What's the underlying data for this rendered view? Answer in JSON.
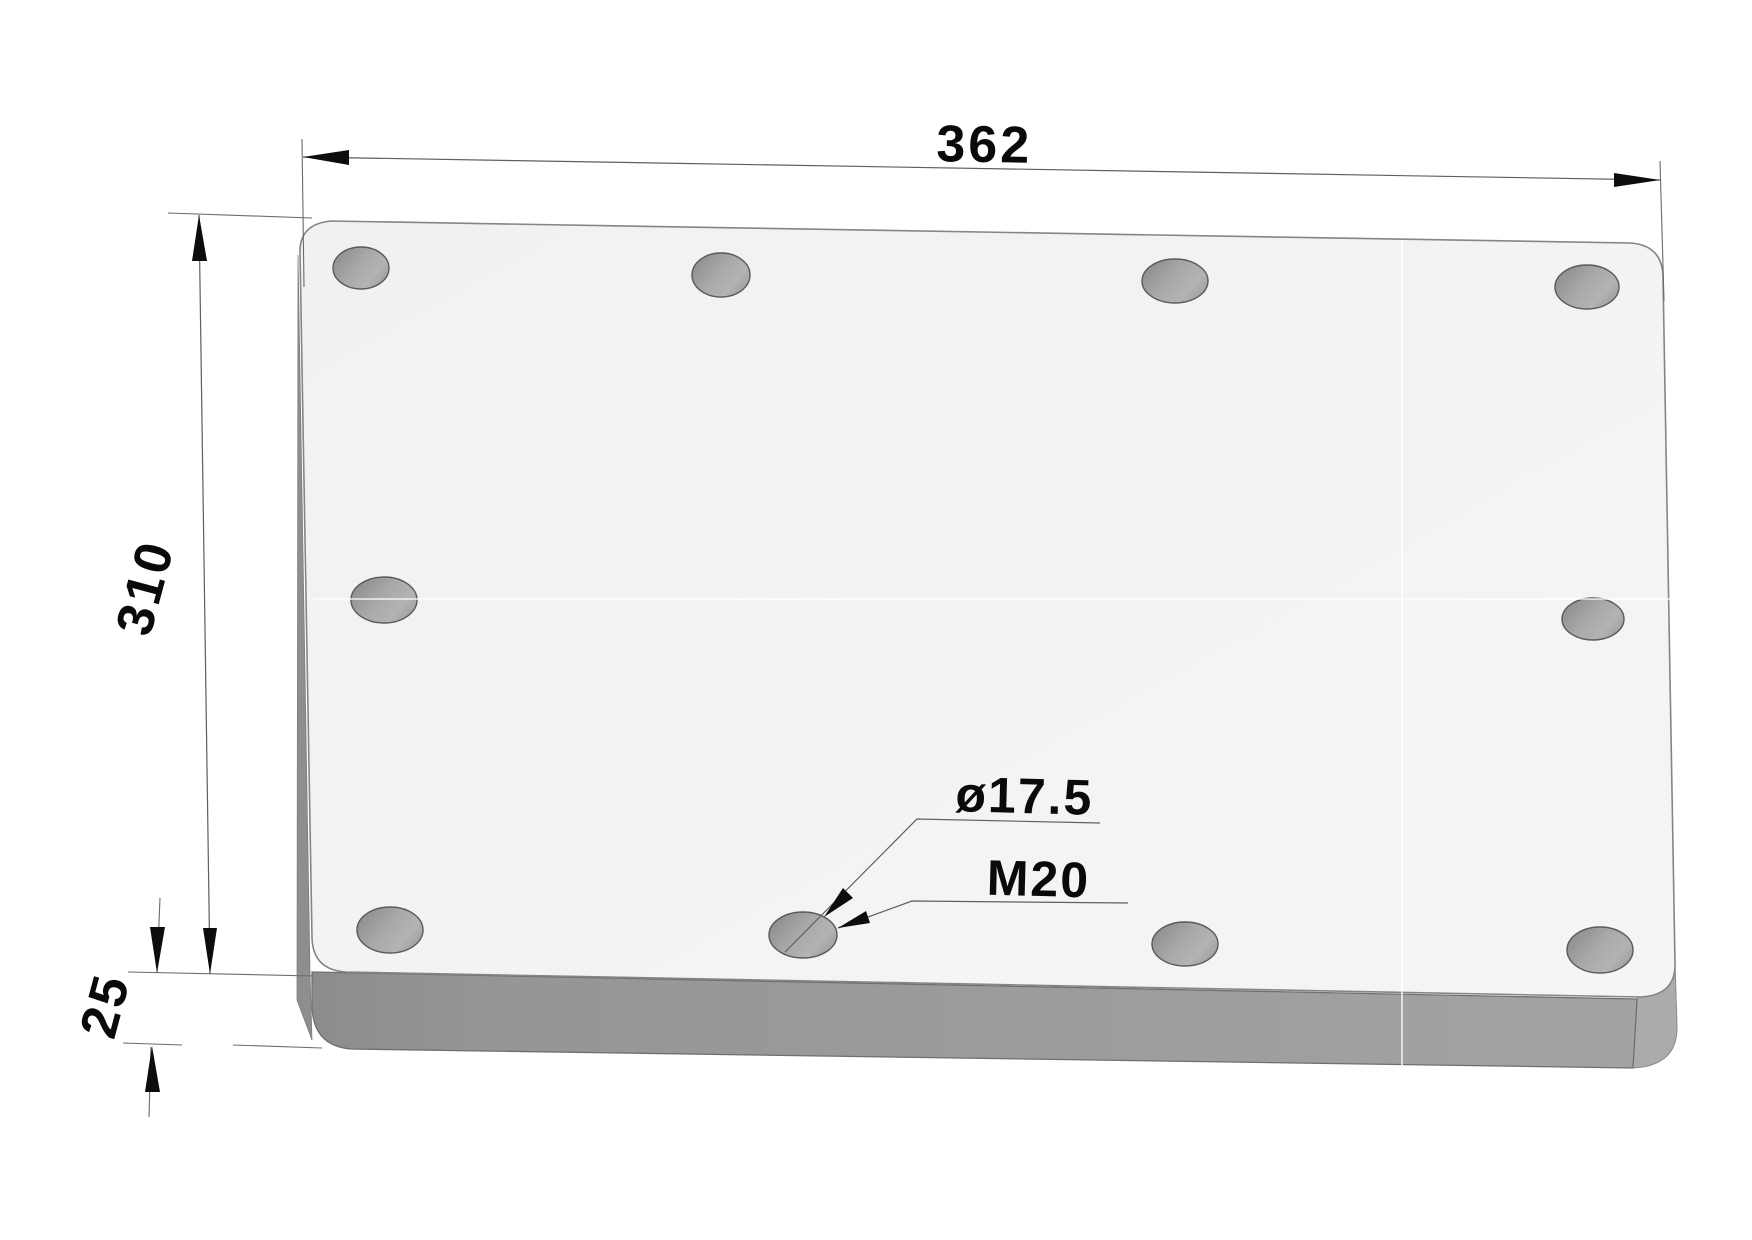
{
  "drawing": {
    "title": "rectangular mounting plate - dimensioned 3D view",
    "dimensions": {
      "width_label": "362",
      "height_label": "310",
      "thickness_label": "25",
      "hole_diameter_label": "ø17.5",
      "thread_label": "M20"
    },
    "part": {
      "shape": "rectangular-plate-with-rounded-corners",
      "width_mm": 362,
      "depth_mm": 310,
      "thickness_mm": 25,
      "hole_count": 10,
      "hole_diameter_mm": 17.5,
      "thread": "M20"
    },
    "holes": [
      {
        "cx": 361,
        "cy": 268,
        "rx": 28,
        "ry": 21
      },
      {
        "cx": 721,
        "cy": 275,
        "rx": 29,
        "ry": 22
      },
      {
        "cx": 1175,
        "cy": 281,
        "rx": 33,
        "ry": 22
      },
      {
        "cx": 1587,
        "cy": 287,
        "rx": 32,
        "ry": 22
      },
      {
        "cx": 384,
        "cy": 600,
        "rx": 33,
        "ry": 23
      },
      {
        "cx": 1593,
        "cy": 619,
        "rx": 31,
        "ry": 21
      },
      {
        "cx": 390,
        "cy": 930,
        "rx": 33,
        "ry": 23
      },
      {
        "cx": 803,
        "cy": 935,
        "rx": 34,
        "ry": 23
      },
      {
        "cx": 1185,
        "cy": 944,
        "rx": 33,
        "ry": 22
      },
      {
        "cx": 1600,
        "cy": 950,
        "rx": 33,
        "ry": 23
      }
    ],
    "colors": {
      "background": "#ffffff",
      "top_face": "#f3f3f4",
      "front_face_dark": "#8c8c8c",
      "front_face_light": "#a3a3a3",
      "side_wedge": "#ababab",
      "left_sliver": "#8e8e8e",
      "hole_dark": "#8c8c8c",
      "hole_light": "#b3b3b3",
      "hole_stroke": "#5a5a5a",
      "outline": "#858585",
      "dim_line": "#5f5f5f",
      "text": "#0a0a0a"
    }
  }
}
